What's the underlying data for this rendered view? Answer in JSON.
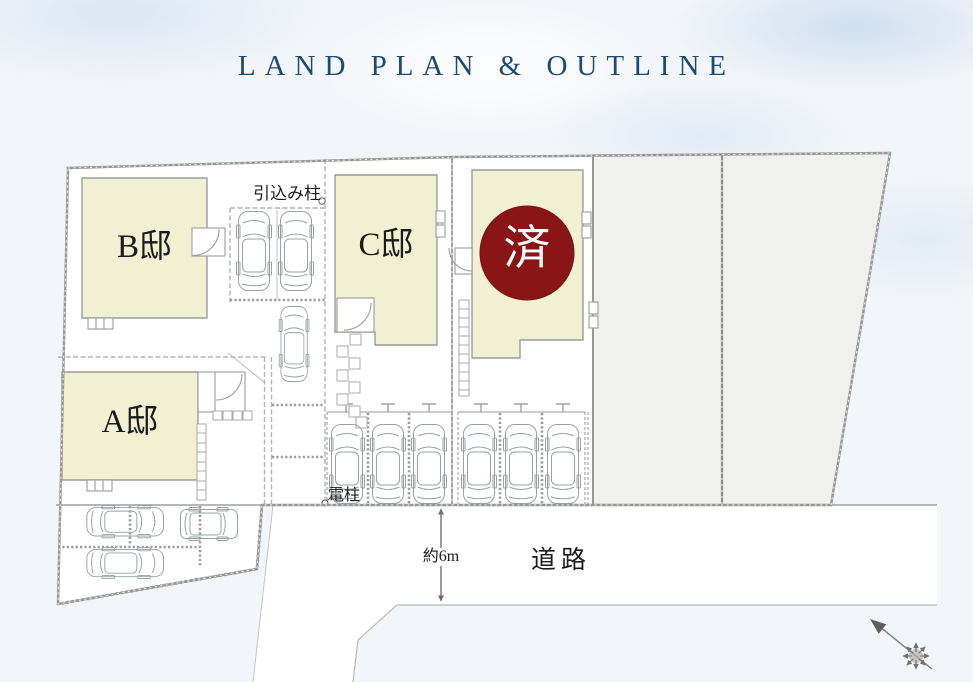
{
  "title": "LAND PLAN & OUTLINE",
  "lots": {
    "a": {
      "label": "A邸"
    },
    "b": {
      "label": "B邸"
    },
    "c": {
      "label": "C邸"
    },
    "d": {
      "label": "済",
      "status": "sold"
    }
  },
  "annotations": {
    "service_pole": "引込み柱",
    "utility_pole": "電柱",
    "road_width": "約6m",
    "road": "道路"
  },
  "colors": {
    "title_navy": "#1d4973",
    "building_fill": "#f1f0d2",
    "sold_circle": "#8a1516",
    "vacant_lot_fill": "#f0f0ee",
    "boundary_gray": "#9a9a9a"
  },
  "icons": {
    "north_arrow": "north-arrow-compass"
  }
}
